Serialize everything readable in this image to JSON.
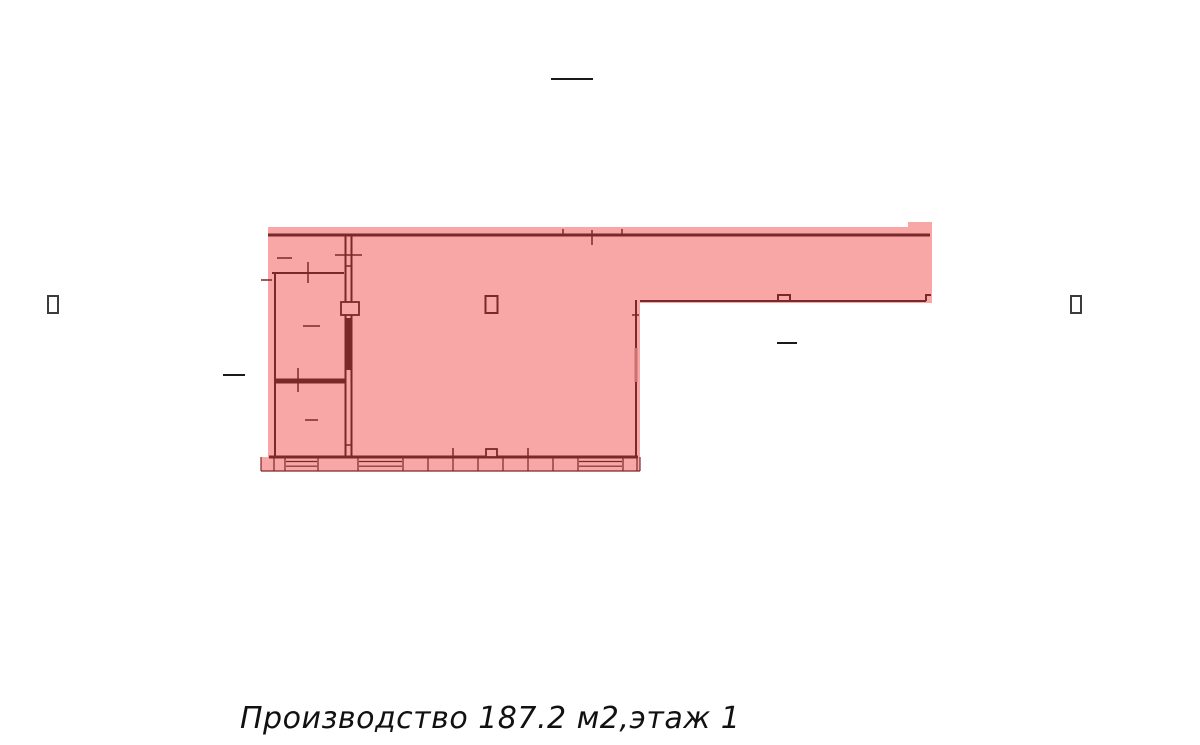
{
  "caption": {
    "text": "Производство 187.2 м2,этаж 1",
    "room_type": "Производство",
    "area_m2": "187.2",
    "floor": "1"
  },
  "marks": {
    "left_glyph": "missing-glyph-box",
    "right_glyph": "missing-glyph-box",
    "room_glyph": "missing-glyph-box"
  },
  "colors": {
    "background": "#ffffff",
    "highlight_fill": "#f9a6a6",
    "wall": "#7a2828",
    "door": "#cc7070",
    "mark": "#1a1a1a",
    "missing_glyph": "#3c3c3c"
  }
}
